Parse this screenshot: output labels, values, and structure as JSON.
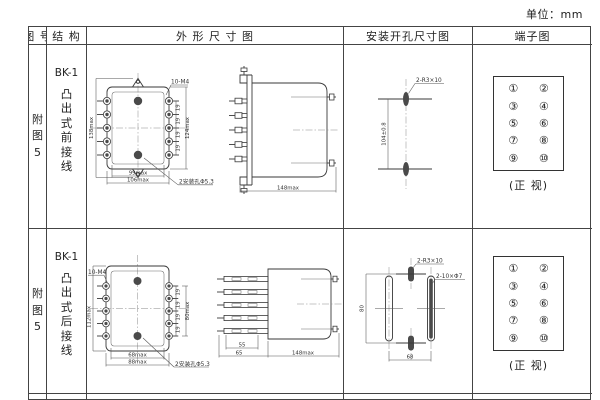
{
  "page": {
    "unit_label": "单位：mm"
  },
  "table": {
    "headers": {
      "figure": "图 号",
      "structure": "结 构",
      "outline": "外 形 尺 寸 图",
      "mounting": "安装开孔尺寸图",
      "terminal": "端子图"
    }
  },
  "rows": [
    {
      "figure_no": "附\n图\n5",
      "model": "BK-1",
      "structure": "凸\n出\n式\n前\n接\n线",
      "outline": {
        "screw_note": "10-M4",
        "dim_height": "138max",
        "dim_pitch": "19",
        "dim_terms": "124max",
        "dim_hole_span": "99max",
        "dim_width": "106max",
        "hole_note": "2安装孔Φ5.3",
        "side_dim_depth": "148max"
      },
      "mounting": {
        "hole_label": "2-R3×10",
        "dim_vertical": "104±0.8"
      },
      "terminal": {
        "cells": [
          "①",
          "②",
          "③",
          "④",
          "⑤",
          "⑥",
          "⑦",
          "⑧",
          "⑨",
          "⑩"
        ],
        "caption": "(正 视)"
      }
    },
    {
      "figure_no": "附\n图\n5",
      "model": "BK-1",
      "structure": "凸\n出\n式\n后\n接\n线",
      "outline": {
        "screw_note": "10-M4",
        "dim_height": "112max",
        "dim_pitch": "19",
        "dim_terms": "80max",
        "dim_hole_span": "68max",
        "dim_width": "88max",
        "hole_note": "2安装孔Φ5.3",
        "side_dim_pins": "55",
        "side_dim_front": "65",
        "side_dim_depth": "148max"
      },
      "mounting": {
        "slot_label": "2-R3×10",
        "slot_label2": "2-10×Φ7",
        "dim_vertical": "80",
        "dim_horizontal": "68"
      },
      "terminal": {
        "cells": [
          "①",
          "②",
          "③",
          "④",
          "⑤",
          "⑥",
          "⑦",
          "⑧",
          "⑨",
          "⑩"
        ],
        "caption": "(正 视)"
      }
    }
  ]
}
